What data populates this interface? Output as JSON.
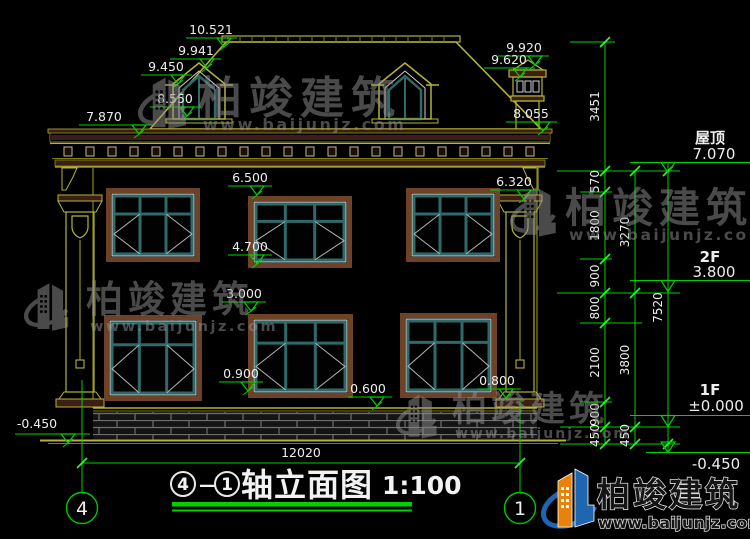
{
  "page": {
    "background": "#000000"
  },
  "drawing": {
    "type": "architectural-elevation",
    "title": {
      "axis_start": "4",
      "dash": "—",
      "axis_end": "1",
      "text": "轴立面图",
      "scale": "1:100"
    },
    "axis_bubbles": [
      {
        "label": "4"
      },
      {
        "label": "1"
      }
    ],
    "bottom_dimension": "12020",
    "elevation_markers": [
      {
        "label": "10.521",
        "tx": 211,
        "ty": 34,
        "x1": 186,
        "x2": 237,
        "y": 38,
        "tip": 224
      },
      {
        "label": "9.941",
        "tx": 196,
        "ty": 55,
        "x1": 170,
        "x2": 221,
        "y": 59,
        "tip": 207
      },
      {
        "label": "9.450",
        "tx": 166,
        "ty": 71,
        "x1": 141,
        "x2": 192,
        "y": 75,
        "tip": 178
      },
      {
        "label": "8.550",
        "tx": 175,
        "ty": 103,
        "x1": 150,
        "x2": 201,
        "y": 107,
        "tip": 187
      },
      {
        "label": "7.870",
        "tx": 104,
        "ty": 121,
        "x1": 79,
        "x2": 152,
        "y": 125,
        "tip": 139
      },
      {
        "label": "9.920",
        "tx": 524,
        "ty": 52,
        "x1": 498,
        "x2": 549,
        "y": 56,
        "tip": 535
      },
      {
        "label": "9.620",
        "tx": 509,
        "ty": 64,
        "x1": 484,
        "x2": 535,
        "y": 68,
        "tip": 520
      },
      {
        "label": "8.055",
        "tx": 531,
        "ty": 118,
        "x1": 506,
        "x2": 557,
        "y": 122,
        "tip": 543
      },
      {
        "label": "6.500",
        "tx": 250,
        "ty": 182,
        "x1": 228,
        "x2": 272,
        "y": 186,
        "tip": 257
      },
      {
        "label": "4.700",
        "tx": 250,
        "ty": 251,
        "x1": 228,
        "x2": 272,
        "y": 255,
        "tip": 257
      },
      {
        "label": "6.320",
        "tx": 514,
        "ty": 186,
        "x1": 490,
        "x2": 540,
        "y": 190,
        "tip": 524
      },
      {
        "label": "3.000",
        "tx": 244,
        "ty": 298,
        "x1": 222,
        "x2": 266,
        "y": 302,
        "tip": 251
      },
      {
        "label": "0.900",
        "tx": 241,
        "ty": 378,
        "x1": 219,
        "x2": 263,
        "y": 382,
        "tip": 248
      },
      {
        "label": "0.600",
        "tx": 368,
        "ty": 393,
        "x1": 348,
        "x2": 392,
        "y": 397,
        "tip": 377
      },
      {
        "label": "0.800",
        "tx": 497,
        "ty": 385,
        "x1": 477,
        "x2": 521,
        "y": 389,
        "tip": 506
      },
      {
        "label": "-0.450",
        "tx": 37,
        "ty": 428,
        "x1": 15,
        "x2": 90,
        "y": 434,
        "tip": 68
      }
    ],
    "dim_chains": [
      {
        "x": 605,
        "points": [
          42,
          171,
          192,
          259,
          293,
          323,
          402,
          427,
          444
        ],
        "labels": [
          "3451",
          "570",
          "1800",
          "900",
          "800",
          "2100",
          "900",
          "450"
        ]
      },
      {
        "x": 635,
        "points": [
          171,
          293,
          427,
          444
        ],
        "labels": [
          "3270",
          "3800",
          "450"
        ]
      },
      {
        "x": 668,
        "points": [
          171,
          444
        ],
        "labels": [
          "7520"
        ],
        "line_extend": [
          162,
          453
        ]
      }
    ],
    "ext_lines": [
      [
        570,
        42,
        615,
        42
      ],
      [
        557,
        171,
        680,
        171
      ],
      [
        580,
        192,
        612,
        192
      ],
      [
        580,
        259,
        612,
        259
      ],
      [
        557,
        293,
        680,
        293
      ],
      [
        580,
        323,
        642,
        323
      ],
      [
        580,
        402,
        612,
        402
      ],
      [
        560,
        427,
        680,
        427
      ],
      [
        560,
        444,
        680,
        444
      ]
    ],
    "level_flags": [
      {
        "name": "屋顶",
        "value": "7.070"
      },
      {
        "name": "2F",
        "value": "3.800"
      },
      {
        "name": "1F",
        "value": "±0.000"
      },
      {
        "name": "",
        "value": "-0.450"
      }
    ]
  },
  "watermark": {
    "brand": "柏竣建筑",
    "url": "www.baijunjz.com"
  },
  "colors": {
    "background": "#000000",
    "dimension_green": "#00d200",
    "text_white": "#ededed",
    "outline_olive": "#b5b336",
    "window_teal": "#2e6a6a",
    "frame_brown": "#6e4226",
    "fascia_maroon": "#3c1e14",
    "tile_gray": "#4f4f4f",
    "watermark_gray": "#8f8f8f",
    "logo_blue": "#1f66b0",
    "logo_orange": "#e8820a"
  }
}
